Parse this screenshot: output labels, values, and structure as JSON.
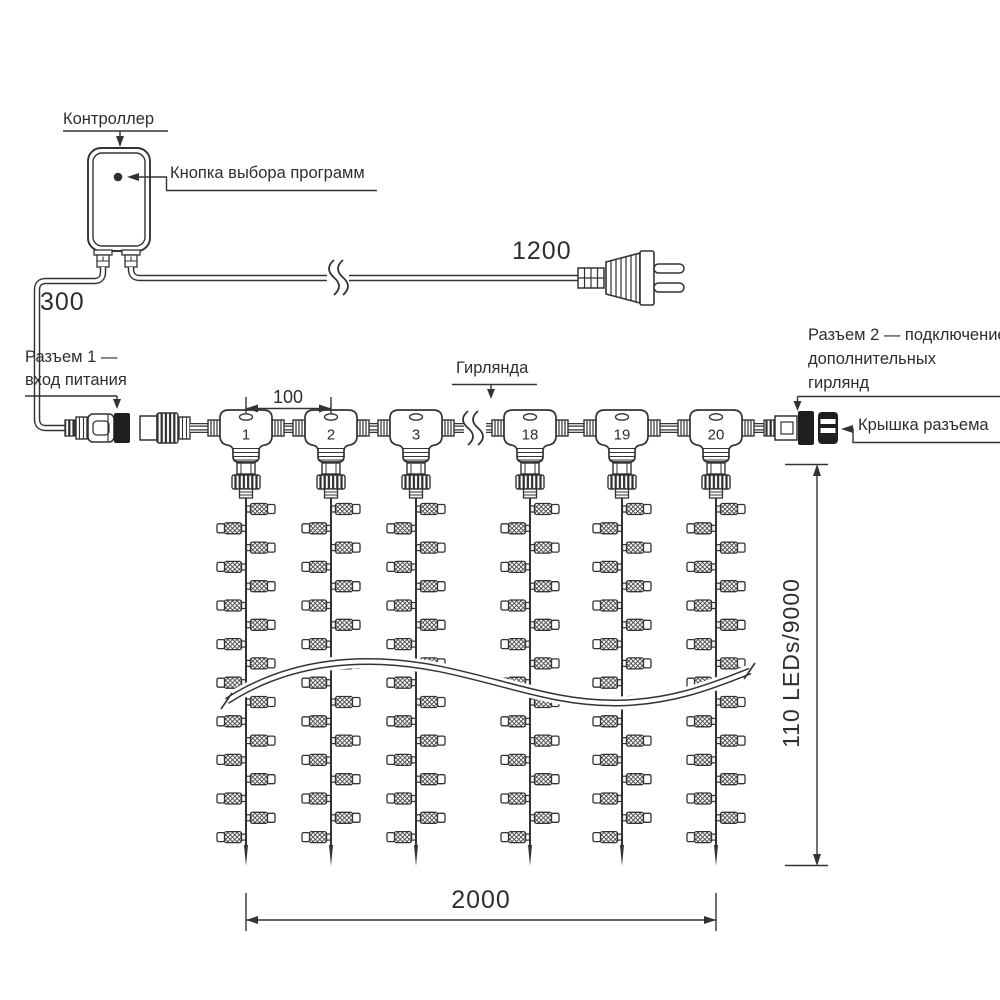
{
  "diagram": {
    "controller": {
      "label": "Контроллер",
      "button_label": "Кнопка выбора программ"
    },
    "power": {
      "cable_length_label": "1200",
      "lead_length_label": "300"
    },
    "connector1": {
      "label_line1": "Разъем 1 —",
      "label_line2": "вход питания"
    },
    "connector2": {
      "label_line1": "Разъем 2 — подключение",
      "label_line2": "дополнительных",
      "label_line3": "гирлянд"
    },
    "cap": {
      "label": "Крышка разъема"
    },
    "garland": {
      "label": "Гирлянда",
      "tees": [
        {
          "label": "1"
        },
        {
          "label": "2"
        },
        {
          "label": "3"
        },
        {
          "label": "18"
        },
        {
          "label": "19"
        },
        {
          "label": "20"
        }
      ],
      "strings": {
        "count": 6,
        "lamps_per_string": 18
      }
    },
    "dimensions": {
      "spacing_label": "100",
      "width_label": "2000",
      "height_label": "110 LEDs/9000"
    },
    "line_color": "#333333"
  }
}
